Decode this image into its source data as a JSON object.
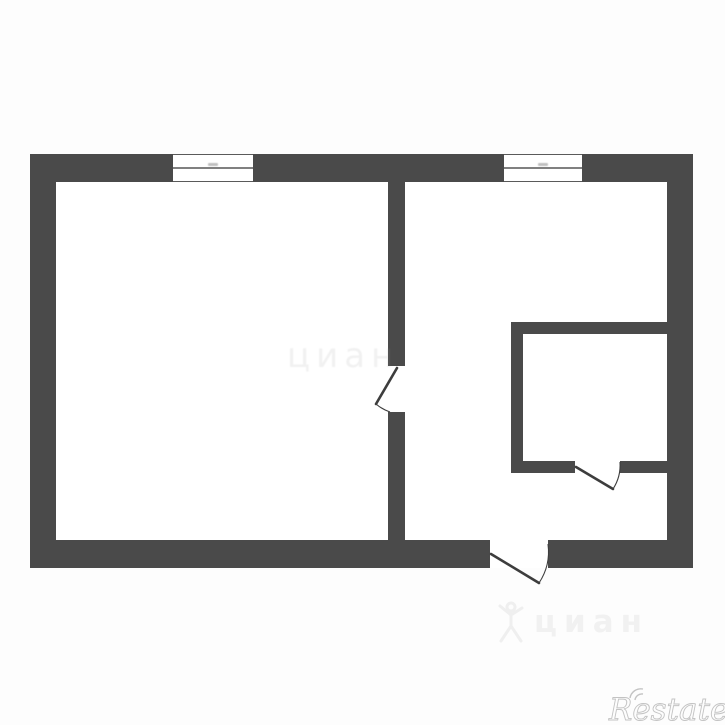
{
  "image": {
    "kind": "real-estate floor plan scan",
    "rooms_visible": 3,
    "windows_count": 2,
    "doors_count": 3
  },
  "colors": {
    "background": "#fdfdfd",
    "floor": "#ffffff",
    "wall": "#4a4a4a",
    "door_line": "#3d3d3d",
    "restate_stroke": "#c3c3c3",
    "cian_watermark": "#f1f1f1"
  },
  "watermarks": {
    "restate": {
      "label": "Restate"
    },
    "cian_bottom": {
      "label": "циан"
    },
    "cian_center": {
      "label": "циан"
    }
  }
}
